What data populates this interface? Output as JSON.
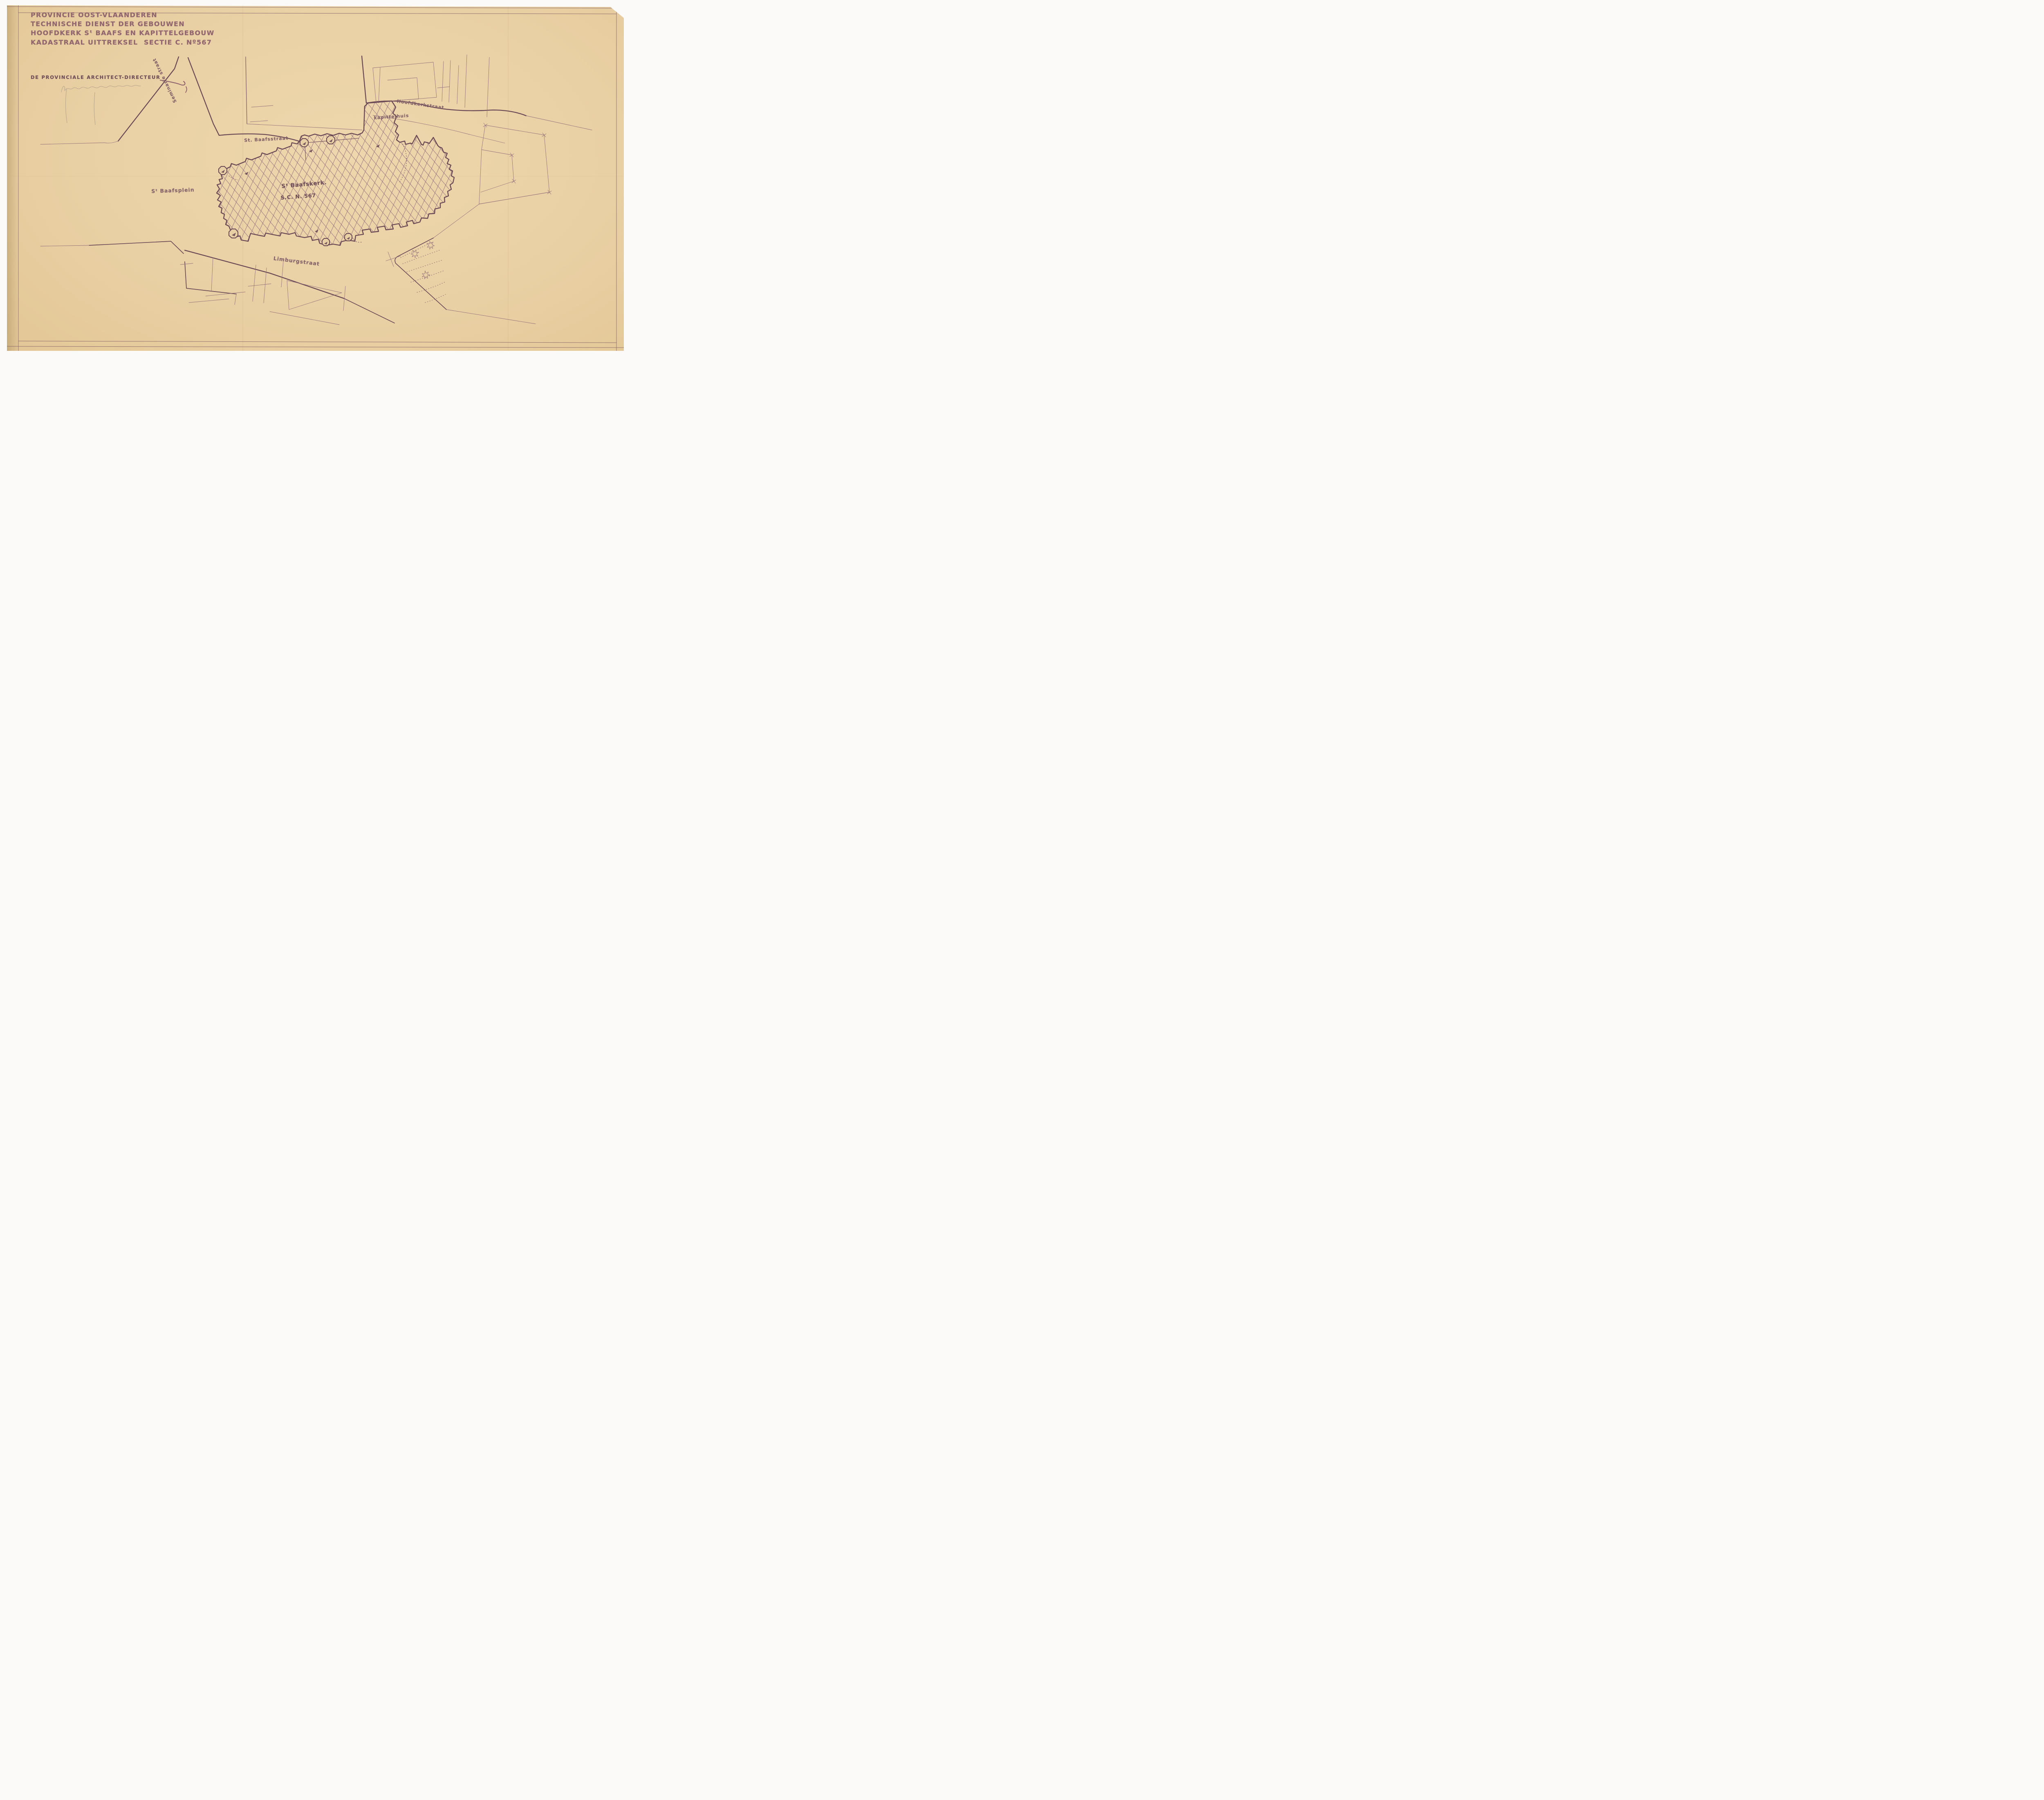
{
  "document": {
    "province_line": "PROVINCIE OOST-VLAANDEREN",
    "service_line": "TECHNISCHE DIENST DER GEBOUWEN",
    "building_line": "HOOFDKERK Sᵗ BAAFS EN KAPITTELGEBOUW",
    "extract_line": "KADASTRAAL UITTREKSEL",
    "section_line": "SECTIE C. Nº567",
    "signatory_title": "DE PROVINCIALE ARCHITECT-DIRECTEUR"
  },
  "map": {
    "streets": {
      "seminarie": "Seminarie straat",
      "st_baafsstraat": "St. Baafsstraat",
      "hoofdkerkstraat": "Hoofdkerkstraat",
      "limburgstraat": "Limburgstraat"
    },
    "places": {
      "square": "Sᵗ Baafsplein",
      "church_name": "Sᵗ Baafskerk.",
      "church_parcel": "S.C. N. 567",
      "chapter_house": "kapittelhuis"
    }
  },
  "colors": {
    "paper": "#e9d0a4",
    "ink_heavy": "#6b4a56",
    "ink_medium": "#7d5a65",
    "ink_light": "#926e78",
    "ink_title": "#8a5e6a",
    "hatch": "#9b7581",
    "pencil": "#b7a68d",
    "scanner_bg": "#fbfaf8"
  }
}
